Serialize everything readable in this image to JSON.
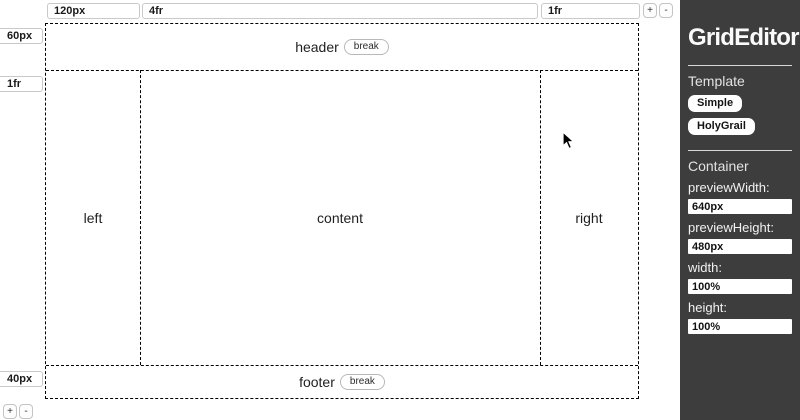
{
  "app": {
    "title": "GridEditor"
  },
  "canvas": {
    "column_tracks": [
      "120px",
      "4fr",
      "1fr"
    ],
    "row_tracks": [
      "60px",
      "1fr",
      "40px"
    ],
    "add_track_label": "+",
    "remove_track_label": "-",
    "regions": {
      "header": "header",
      "left": "left",
      "content": "content",
      "right": "right",
      "footer": "footer"
    },
    "break_label": "break"
  },
  "sidebar": {
    "title": "GridEditor",
    "template": {
      "heading": "Template",
      "buttons": [
        "Simple",
        "HolyGrail"
      ]
    },
    "container": {
      "heading": "Container",
      "fields": [
        {
          "label": "previewWidth:",
          "value": "640px"
        },
        {
          "label": "previewHeight:",
          "value": "480px"
        },
        {
          "label": "width:",
          "value": "100%"
        },
        {
          "label": "height:",
          "value": "100%"
        }
      ]
    }
  },
  "colors": {
    "sidebar_bg": "#3d3d3d",
    "canvas_bg": "#ffffff",
    "grid_border": "#000000",
    "input_border": "#c9c9c9"
  }
}
